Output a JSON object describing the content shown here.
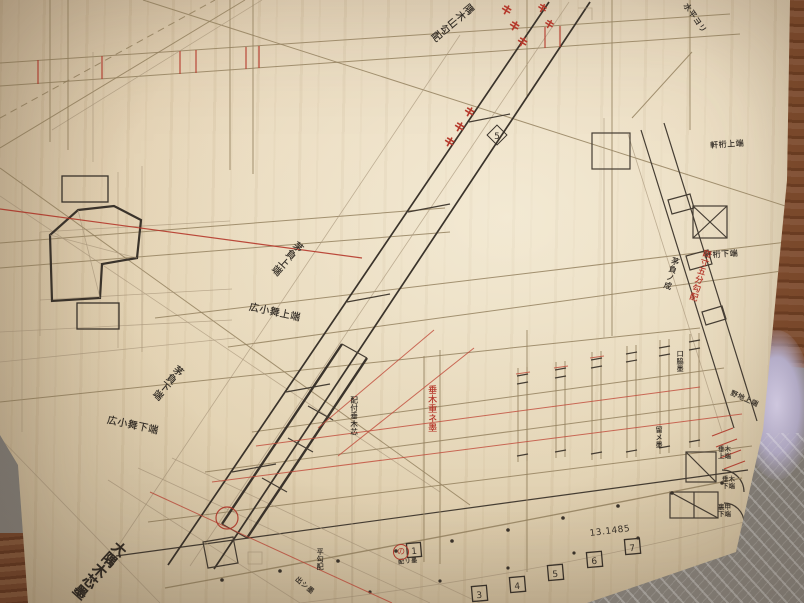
{
  "colors": {
    "board_wood": "#e6d6b7",
    "ink_black": "#3a332b",
    "pencil": "#94815f",
    "red_ink": "#b5372a",
    "floor_grey": "#8d8881",
    "plank_brown": "#7c4a2c",
    "background_lavender": "#d8d1ea"
  },
  "labels": {
    "hip_top": "隅木山勾配",
    "level_ref": "水平ヨリ",
    "noji": "野地上端",
    "girder_top": "軒桁上端",
    "girder_bottom": "軒桁下端",
    "kayaoi_top": "茅負上端",
    "hirokomai_top": "広小舞上端",
    "kayaoi_bottom": "茅負下端",
    "hirokomai_bottom": "広小舞下端",
    "main_hip": "大隅木芯墨",
    "rafter_overlap": "垂木重ネ墨",
    "haitsuke": "配付垂木芯",
    "kuchiwaki": "口脇墨",
    "kayaoi_sei": "茅負ノ成",
    "pitch": "四寸五分勾配",
    "tome": "留メ墨",
    "edge_top": "垂木上端",
    "edge_bottom": "垂木下端",
    "urako": "裏甲下端",
    "hira": "平勾配",
    "dashi": "出シ墨",
    "awase": "配リ墨"
  },
  "stations": {
    "squares": [
      "1",
      "3",
      "4",
      "5",
      "6",
      "7"
    ],
    "diamond": "5"
  },
  "measurement": "13.1485",
  "match_mark": "キ",
  "red_circle_mark": "の"
}
